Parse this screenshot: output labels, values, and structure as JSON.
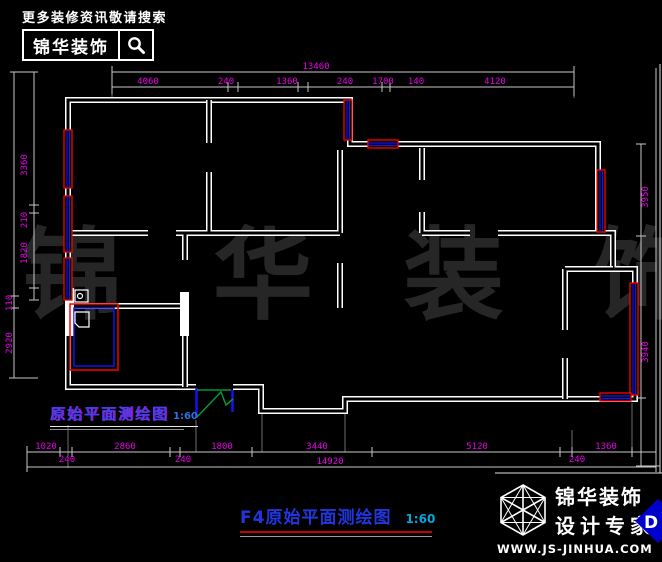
{
  "header": {
    "tagline": "更多装修资讯敬请搜索",
    "brand": "锦华装饰",
    "icon": "magnifier-search-icon"
  },
  "watermark": "锦 华 装 饰",
  "plan_label": {
    "text": "原始平面测绘图",
    "scale": "1:60"
  },
  "title_block": {
    "text": "F4原始平面测绘图",
    "scale": "1:60"
  },
  "footer": {
    "brand": "锦华装饰",
    "subtitle": "设计专家",
    "website": "WWW.JS-JINHUA.COM",
    "badge": "D",
    "icon": "wireframe-cube-logo"
  },
  "dimensions": {
    "top_total": "13460",
    "top": [
      "4060",
      "240",
      "1360",
      "240",
      "1700",
      "140",
      "4120"
    ],
    "left": [
      "3360",
      "210",
      "1820",
      "110",
      "2920"
    ],
    "right": [
      "3950",
      "3940"
    ],
    "bottom": [
      "1020",
      "240",
      "2860",
      "240",
      "1800",
      "3440",
      "5120",
      "240",
      "1360"
    ],
    "bottom_total": "14920"
  },
  "colors": {
    "background": "#000000",
    "walls": "#ffffff",
    "dimension_text": "#e800e8",
    "dimension_lines": "#c8c8c8",
    "window_frame": "#ff0000",
    "window_glass": "#1313ee",
    "door": "#009933",
    "label_blue": "#4343ef",
    "title_blue": "#2236dd",
    "scale_cyan": "#00a8dd",
    "underline_red": "#c40000",
    "watermark": "#262626",
    "badge_blue": "#0000cc"
  }
}
